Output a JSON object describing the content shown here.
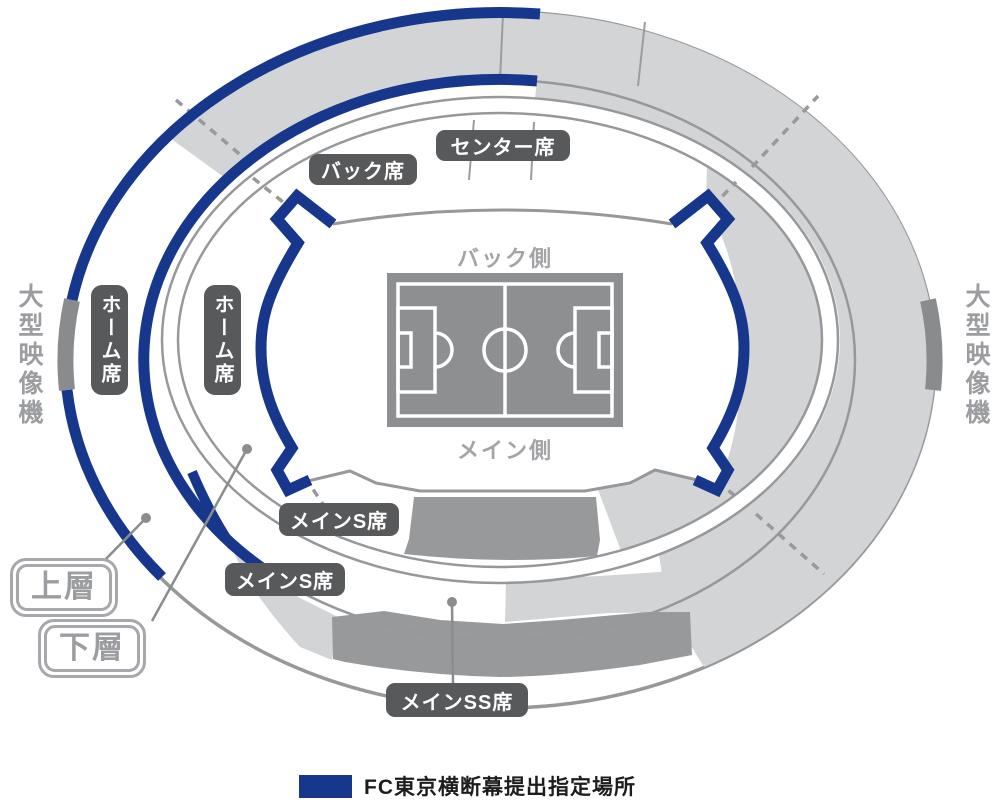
{
  "colors": {
    "banner_blue": "#17378c",
    "section_light_gray": "#d3d4d6",
    "stand_gray": "#98999b",
    "pitch_gray": "#8e8f91",
    "pill_gray": "#58595b",
    "line_gray": "#96989b",
    "label_text_gray": "#9b9da0"
  },
  "labels": {
    "center_stand": "センター席",
    "back_stand": "バック席",
    "home_upper": "ホーム席",
    "home_lower": "ホーム席",
    "main_s_upper": "メインS席",
    "main_s_lower": "メインS席",
    "main_ss": "メインSS席",
    "pitch_back_side": "バック側",
    "pitch_main_side": "メイン側",
    "screen_left": "大型映像機",
    "screen_right": "大型映像機",
    "tier_upper": "上層",
    "tier_lower": "下層"
  },
  "legend": {
    "label": "FC東京横断幕提出指定場所",
    "swatch_color": "#17378c"
  }
}
